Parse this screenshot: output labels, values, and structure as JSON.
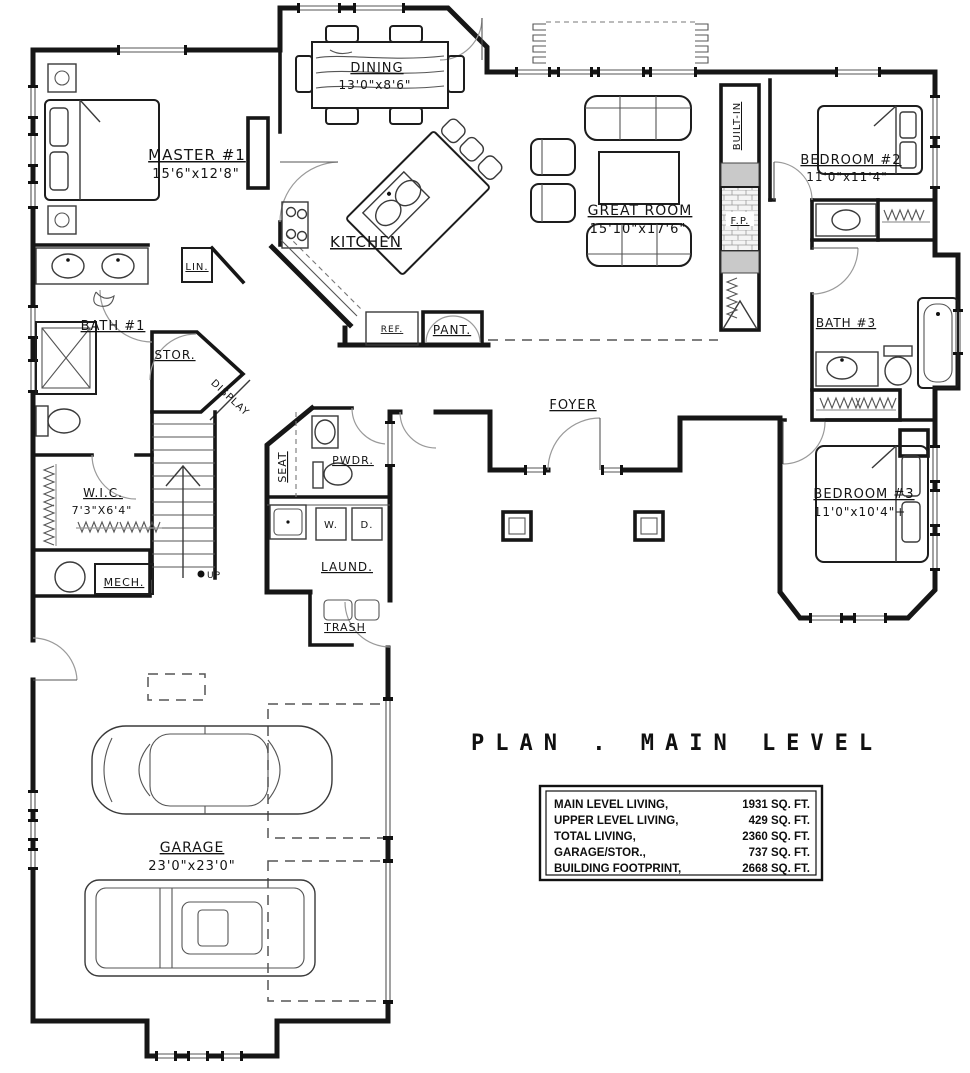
{
  "doc": {
    "type": "architectural-floor-plan",
    "title": "PLAN . MAIN LEVEL"
  },
  "rooms": {
    "master": {
      "name": "MASTER #1",
      "dims": "15'6\"x12'8\""
    },
    "dining": {
      "name": "DINING",
      "dims": "13'0\"x8'6\""
    },
    "kitchen": {
      "name": "KITCHEN"
    },
    "great_room": {
      "name": "GREAT ROOM",
      "dims": "15'10\"x17'6\""
    },
    "bedroom2": {
      "name": "BEDROOM #2",
      "dims": "11'0\"x11'4\""
    },
    "bedroom3": {
      "name": "BEDROOM #3",
      "dims": "11'0\"x10'4\"+"
    },
    "bath1": {
      "name": "BATH #1"
    },
    "bath3": {
      "name": "BATH #3"
    },
    "wic": {
      "name": "W.I.C.",
      "dims": "7'3\"X6'4\""
    },
    "foyer": {
      "name": "FOYER"
    },
    "garage": {
      "name": "GARAGE",
      "dims": "23'0\"x23'0\""
    },
    "laundry": {
      "name": "LAUND."
    },
    "powder": {
      "name": "PWDR."
    },
    "mech": {
      "name": "MECH."
    },
    "storage": {
      "name": "STOR."
    },
    "trash": {
      "name": "TRASH"
    },
    "linen": {
      "name": "LIN."
    },
    "seat": {
      "name": "SEAT"
    },
    "display": {
      "name": "DISPLAY"
    },
    "built_in": {
      "name": "BUILT-IN"
    },
    "fireplace": {
      "name": "F.P."
    },
    "fridge": {
      "name": "REF."
    },
    "pantry": {
      "name": "PANT."
    },
    "washer": {
      "name": "W."
    },
    "dryer": {
      "name": "D."
    },
    "stairs": {
      "name": "UP"
    }
  },
  "stats": {
    "rows": [
      {
        "label": "MAIN LEVEL LIVING,",
        "value": "1931 SQ. FT."
      },
      {
        "label": "UPPER LEVEL LIVING,",
        "value": "429 SQ. FT."
      },
      {
        "label": "TOTAL LIVING,",
        "value": "2360 SQ. FT."
      },
      {
        "label": "GARAGE/STOR.,",
        "value": "737 SQ. FT."
      },
      {
        "label": "BUILDING FOOTPRINT,",
        "value": "2668 SQ. FT."
      }
    ]
  }
}
